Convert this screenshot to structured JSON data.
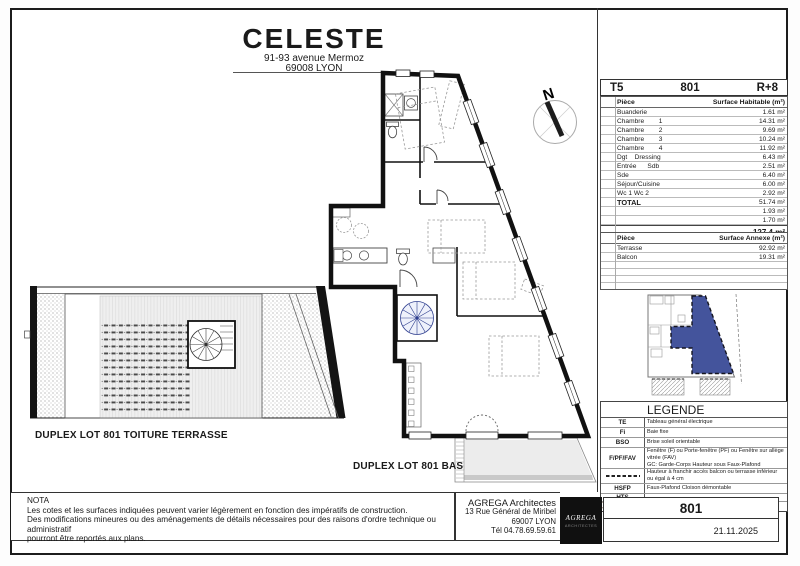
{
  "sheet": {
    "project": {
      "name": "CELESTE",
      "address1": "91-93 avenue Mermoz",
      "address2": "69008 LYON"
    },
    "header": {
      "type": "T5",
      "lot": "801",
      "level": "R+8"
    },
    "surface_table": {
      "col_room": "Pièce",
      "col_surface": "Surface Habitable (m²)",
      "rows": [
        {
          "label": "Buanderie",
          "value": "1.61 m²"
        },
        {
          "label": "Chambre        1",
          "value": "14.31 m²"
        },
        {
          "label": "Chambre        2",
          "value": "9.69 m²"
        },
        {
          "label": "Chambre        3",
          "value": "10.24 m²"
        },
        {
          "label": "Chambre        4",
          "value": "11.92 m²"
        },
        {
          "label": "Dgt    Dressing",
          "value": "6.43 m²"
        },
        {
          "label": "Entrée      Sdb",
          "value": "2.51 m²"
        },
        {
          "label": "Sde",
          "value": "6.40 m²"
        },
        {
          "label": "Séjour/Cuisine",
          "value": "6.00 m²"
        },
        {
          "label": "Wc 1 Wc 2",
          "value": "2.92 m²"
        },
        {
          "label": "TOTAL",
          "value": "51.74 m²",
          "bold": true
        },
        {
          "label": "",
          "value": "1.93 m²"
        },
        {
          "label": "",
          "value": "1.70 m²"
        }
      ],
      "grand_total": "127.4 m²"
    },
    "annexe_table": {
      "col_room": "Pièce",
      "col_surface": "Surface Annexe (m²)",
      "rows": [
        {
          "label": "Terrasse",
          "value": "92.92 m²"
        },
        {
          "label": "Balcon",
          "value": "19.31 m²"
        }
      ],
      "empty_rows": 4
    },
    "legend": {
      "title": "LEGENDE",
      "rows": [
        {
          "sym": "TE",
          "sym_type": "text",
          "desc": "Tableau général électrique",
          "h": 9
        },
        {
          "sym": "Fi",
          "sym_type": "text",
          "desc": "Baie fixe",
          "h": 9
        },
        {
          "sym": "BSO",
          "sym_type": "text",
          "desc": "Brise soleil orientable",
          "h": 9
        },
        {
          "sym": "F/PF/FAV",
          "sym_type": "text",
          "desc": "Fenêtre (F) ou Porte-fenêtre (PF) ou Fenêtre sur allège vitrée (FAV)",
          "desc2": "GC: Garde-Corps Hauteur sous Faux-Plafond",
          "h": 15
        },
        {
          "sym": "",
          "sym_type": "dashes",
          "desc": "Hauteur à franchir accès balcon ou terrasse inférieur ou égal à 4 cm",
          "h": 8
        },
        {
          "sym": "HSFP",
          "sym_type": "text",
          "desc": "Faux-Plafond Cloison démontable",
          "h": 9
        },
        {
          "sym": "HTS",
          "sym_type": "text",
          "desc": "",
          "h": 7
        },
        {
          "sym": "",
          "sym_type": "hatch",
          "desc": "",
          "h": 9
        }
      ]
    },
    "plan_labels": {
      "terrace": "DUPLEX LOT 801 TOITURE TERRASSE",
      "lower": "DUPLEX LOT 801 BAS"
    },
    "north_label": "N",
    "nota": {
      "title": "NOTA",
      "line1": "Les cotes et les surfaces indiquées peuvent varier légèrement en fonction des impératifs de construction.",
      "line2": "Des modifications mineures ou des aménagements de détails nécessaires pour des raisons d'ordre technique ou administratif",
      "line3": "pourront être reportés aux plans."
    },
    "architect": {
      "name": "AGREGA Architectes",
      "address1": "13 Rue Général de Miribel",
      "address2": "69007 LYON",
      "phone": "Tél 04.78.69.59.61",
      "logo_top": "AGREGA",
      "logo_bottom": "ARCHITECTES"
    },
    "stamp": {
      "lot": "801",
      "date": "21.11.2025"
    },
    "colors": {
      "unit_highlight": "#44549C",
      "stair_blue": "#2f3f8f",
      "wall_black": "#111111"
    }
  }
}
